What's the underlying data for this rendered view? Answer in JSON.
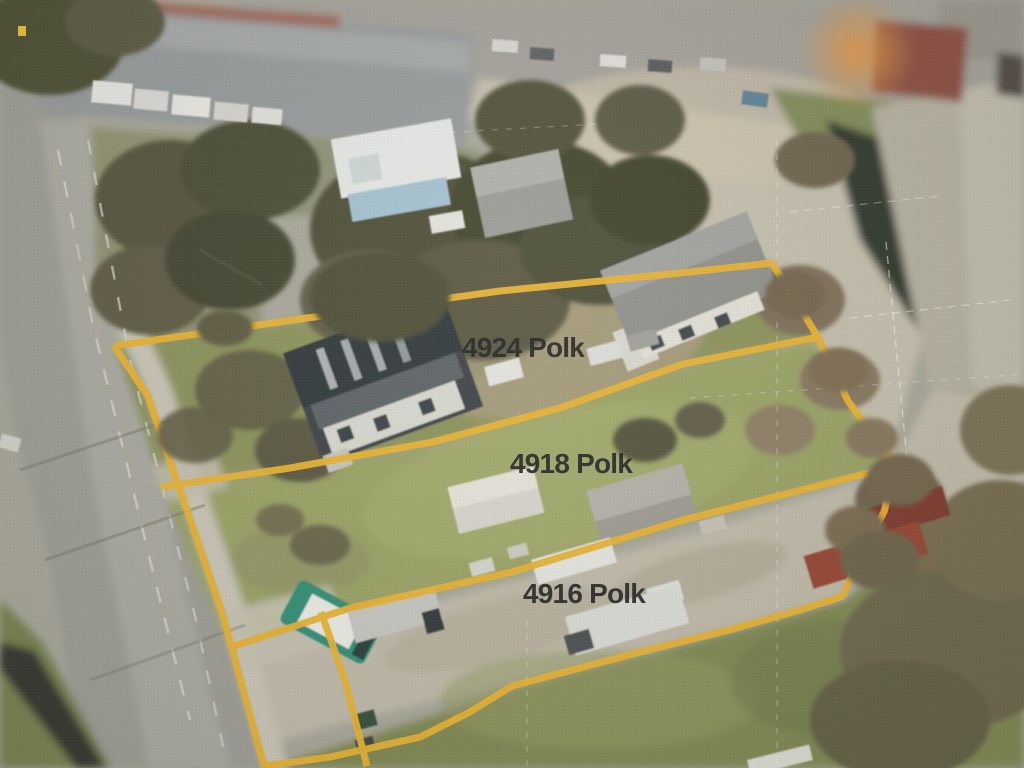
{
  "scene": {
    "type": "annotated aerial photo of three parcels",
    "boundary_color": "#ecb42d",
    "label_color": "#1d1d1d"
  },
  "parcels": [
    {
      "label": "4924 Polk"
    },
    {
      "label": "4918 Polk"
    },
    {
      "label": "4916 Polk"
    }
  ]
}
